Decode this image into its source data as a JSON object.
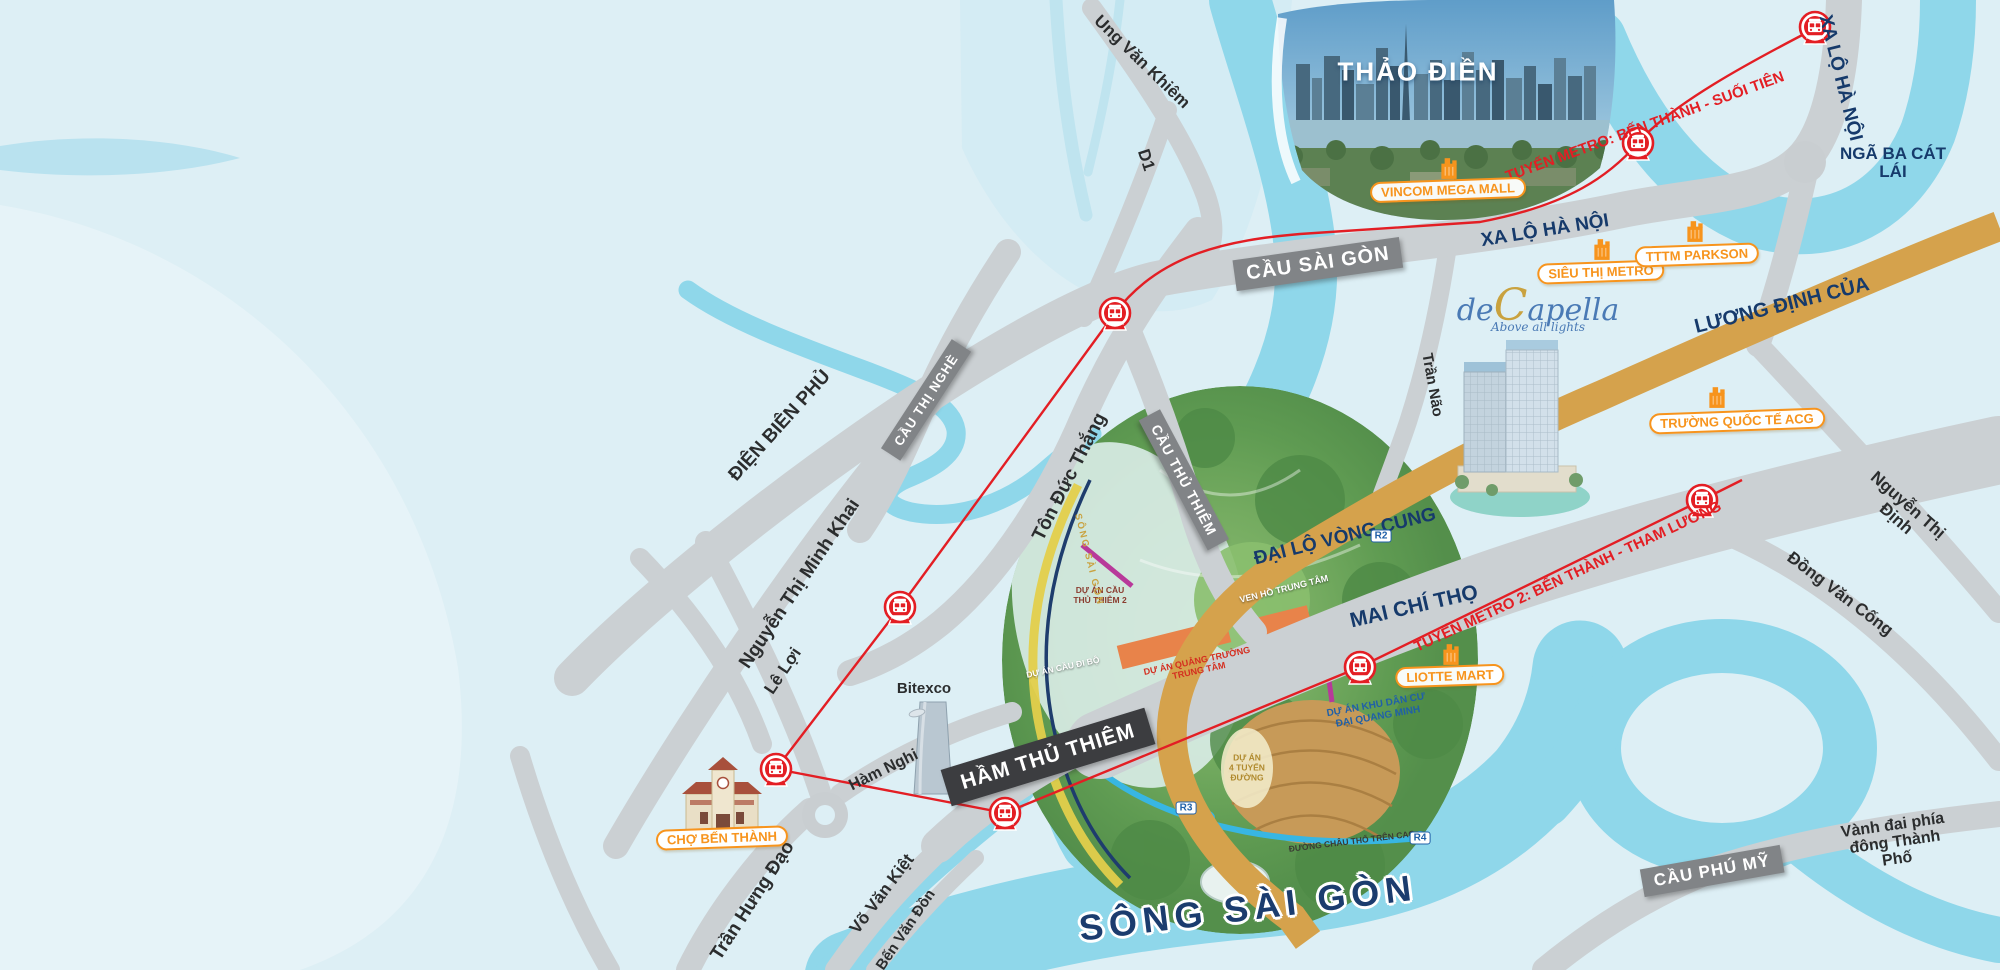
{
  "map_title": "de Capella location map - Ho Chi Minh City",
  "areas": {
    "thao_dien": "THẢO ĐIỀN",
    "nga_ba_cat_lai": "NGÃ BA CÁT LÁI",
    "song_sai_gon": "SÔNG SÀI GÒN"
  },
  "roads": {
    "xa_lo_ha_noi": "XA LỘ HÀ NỘI",
    "luong_dinh_cua": "LƯƠNG ĐỊNH CỦA",
    "dai_lo_vong_cung": "ĐẠI LỘ VÒNG CUNG",
    "mai_chi_tho": "MAI CHÍ THỌ",
    "ung_van_khiem": "Ung Văn Khiêm",
    "d1": "D1",
    "dien_bien_phu": "ĐIỆN BIÊN PHỦ",
    "nguyen_thi_minh_khai": "Nguyễn Thị Minh Khai",
    "ton_duc_thang": "Tôn Đức Thắng",
    "tran_nao": "Trần Não",
    "le_loi": "Lê Lợi",
    "ham_nghi": "Hàm Nghi",
    "tran_hung_dao": "Trần Hưng Đạo",
    "vo_van_kiet": "Võ Văn Kiệt",
    "ben_van_don": "Bến Văn Đồn",
    "nguyen_thi_dinh": "Nguyễn Thị Định",
    "dong_van_cong": "Đồng Văn Cống",
    "vanh_dai": "Vành đai phía đông Thành Phố"
  },
  "bridges": {
    "cau_sai_gon": "CẦU SÀI GÒN",
    "cau_thi_nghe": "CẦU THỊ NGHÈ",
    "cau_thu_thiem": "CẦU THỦ THIÊM",
    "ham_thu_thiem": "HẦM THỦ THIÊM",
    "cau_phu_my": "CẦU PHÚ MỸ"
  },
  "metro": {
    "line1_label": "TUYẾN METRO: BẾN THÀNH - SUỐI TIÊN",
    "line2_label": "TUYẾN METRO 2: BẾN THÀNH - THAM LƯƠNG",
    "station_icon": "metro-train-station-icon"
  },
  "poi": {
    "vincom_mega_mall": "VINCOM MEGA MALL",
    "sieu_thi_metro": "SIÊU THỊ METRO",
    "tttm_parkson": "TTTM PARKSON",
    "truong_quoc_te_acg": "TRƯỜNG QUỐC TẾ ACG",
    "liotte_mart": "LIOTTE MART",
    "cho_ben_thanh": "CHỢ BẾN THÀNH",
    "bitexco": "Bitexco",
    "poi_icon": "orange-building-poi-icon"
  },
  "project": {
    "logo_de": "de",
    "logo_c": "C",
    "logo_rest": "apella",
    "tagline": "Above all lights"
  },
  "masterplan": {
    "ven_ho_trung_tam": "VEN HỒ TRUNG TÂM",
    "quang_truong": "DỰ ÁN QUẢNG TRƯỜNG\nTRUNG TÂM",
    "khu_dan_cu": "DỰ ÁN KHU DÂN CƯ\nĐẠI QUANG MINH",
    "bon_tuyen_duong": "DỰ ÁN\n4 TUYẾN\nĐƯỜNG",
    "cau_thu_thiem_2": "DỰ ÁN CẦU\nTHỦ THIÊM 2",
    "cau_di_bo": "DỰ ÁN CẦU ĐI BỘ",
    "duong_chau_tho": "ĐƯỜNG CHÂU THỔ TRÊN CAO",
    "song_sai_gon_small": "SÔNG SÀI GÒN",
    "r2": "R2",
    "r3": "R3",
    "r4": "R4"
  },
  "colors": {
    "land": "#ddeff5",
    "water": "#8fd7ea",
    "road": "#cbd0d3",
    "gold_road": "#d5a24c",
    "bridge_gray": "#818487",
    "tunnel_dark": "#3c3d40",
    "metro_red": "#e31e24",
    "navy": "#163a6b",
    "poi_orange": "#f7941d"
  }
}
